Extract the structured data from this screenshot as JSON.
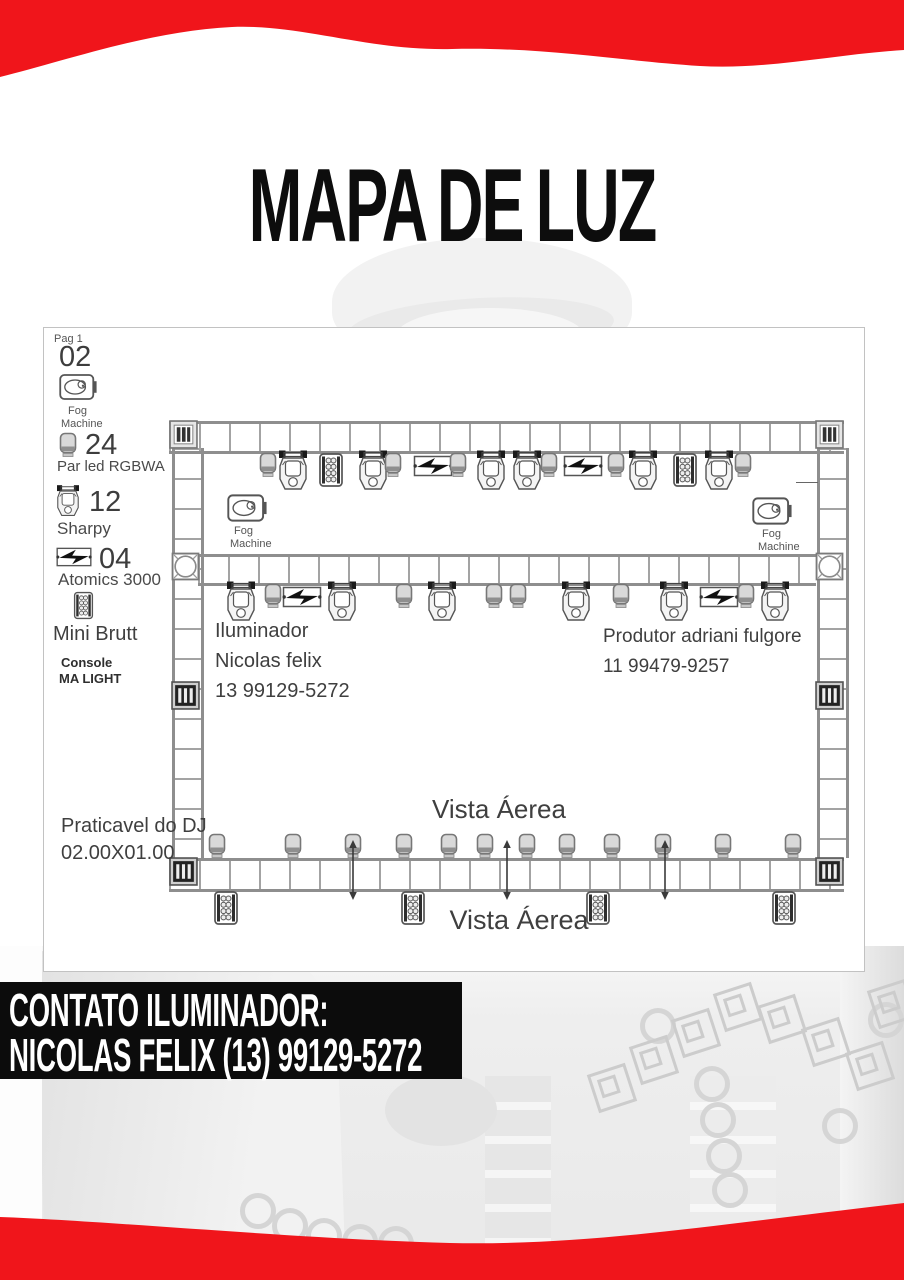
{
  "title": "MAPA DE LUZ",
  "colors": {
    "accent_red": "#f0151b",
    "banner_bg": "#0c0c0c",
    "panel_border": "#c2c2c2",
    "diagram_ink": "#8e8e8e",
    "text": "#3f3f3f"
  },
  "legend": {
    "page_label": "Pag 1",
    "fog": {
      "count": "02",
      "line1": "Fog",
      "line2": "Machine"
    },
    "par": {
      "count": "24",
      "label": "Par led RGBWA"
    },
    "sharpy": {
      "count": "12",
      "label": "Sharpy"
    },
    "atomics": {
      "count": "04",
      "label": "Atomics 3000"
    },
    "brutt": {
      "label": "Mini Brutt"
    },
    "console": {
      "line1": "Console",
      "line2": "MA LIGHT"
    }
  },
  "stage": {
    "iluminador_line1": "Iluminador",
    "iluminador_line2": "Nicolas felix",
    "iluminador_line3": "13 99129-5272",
    "produtor_line1": "Produtor adriani fulgore",
    "produtor_line2": "11 99479-9257",
    "vista_aerea_top": "Vista Áerea",
    "vista_aerea_bottom": "Vista Áerea",
    "praticavel_line1": "Praticavel do DJ",
    "praticavel_line2": "02.00X01.00",
    "fog_left_line1": "Fog",
    "fog_left_line2": "Machine",
    "fog_right_line1": "Fog",
    "fog_right_line2": "Machine"
  },
  "diagram": {
    "fixtures": {
      "top_truss": [
        [
          "par",
          267
        ],
        [
          "mh",
          292
        ],
        [
          "brutt",
          330
        ],
        [
          "mh",
          372
        ],
        [
          "par",
          392
        ],
        [
          "atomics",
          432
        ],
        [
          "par",
          457
        ],
        [
          "mh",
          490
        ],
        [
          "mh",
          526
        ],
        [
          "par",
          548
        ],
        [
          "atomics",
          582
        ],
        [
          "par",
          615
        ],
        [
          "mh",
          642
        ],
        [
          "brutt",
          684
        ],
        [
          "mh",
          718
        ],
        [
          "par",
          742
        ]
      ],
      "mid_truss": [
        [
          "mh",
          240
        ],
        [
          "par",
          272
        ],
        [
          "atomics",
          301
        ],
        [
          "mh",
          341
        ],
        [
          "par",
          403
        ],
        [
          "mh",
          441
        ],
        [
          "par",
          493
        ],
        [
          "par",
          517
        ],
        [
          "mh",
          575
        ],
        [
          "par",
          620
        ],
        [
          "mh",
          673
        ],
        [
          "atomics",
          718
        ],
        [
          "par",
          745
        ],
        [
          "mh",
          774
        ]
      ],
      "bottom_pars": [
        216,
        292,
        352,
        403,
        448,
        484,
        526,
        566,
        611,
        662,
        722,
        792
      ],
      "bottom_brutts": [
        225,
        412,
        597,
        783
      ],
      "rig_arrows": [
        352,
        506,
        664
      ]
    }
  },
  "contact_banner": {
    "line1": "CONTATO ILUMINADOR:",
    "line2": "NICOLAS FELIX (13) 99129-5272"
  }
}
